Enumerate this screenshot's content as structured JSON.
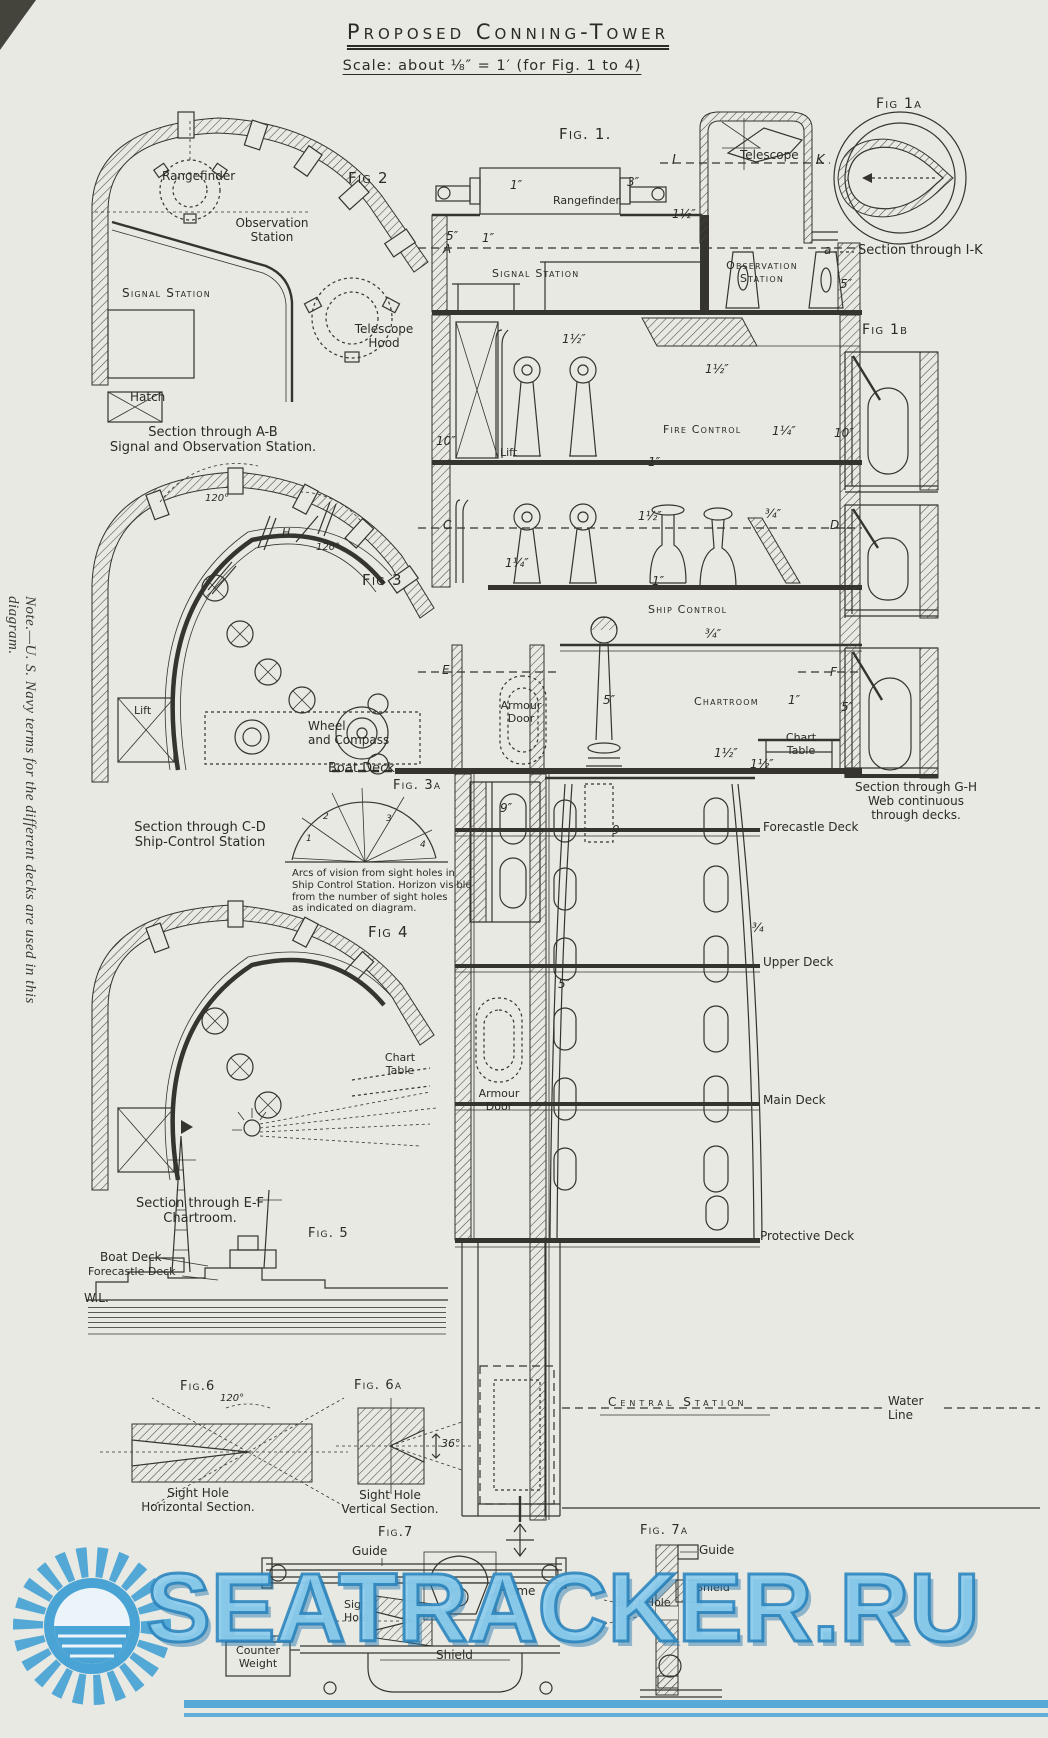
{
  "meta": {
    "title": "Proposed Conning-Tower",
    "subtitle": "Scale: about ⅛″ = 1′ (for Fig. 1 to 4)"
  },
  "side_note": "Note.—U. S. Navy terms for the different decks are used in this diagram.",
  "watermark": {
    "text": "SEATRACKER.RU",
    "color": "#4aa4d8"
  },
  "colors": {
    "paper": "#e8e9e3",
    "ink": "#35342e",
    "watermark_blue": "#4aa4d8"
  },
  "annotations": [
    {
      "name": "fig2-label",
      "text": "Fig 2",
      "x": 348,
      "y": 170,
      "fs": 15,
      "cls": "sc"
    },
    {
      "name": "fig2-rangefinder-label",
      "text": "Rangefinder",
      "x": 162,
      "y": 169,
      "fs": 12
    },
    {
      "name": "fig2-observation-station-label",
      "text": "Observation\nStation",
      "x": 272,
      "y": 216,
      "fs": 12,
      "cls": "c cap"
    },
    {
      "name": "fig2-signal-station-label",
      "text": "Signal Station",
      "x": 122,
      "y": 286,
      "fs": 12,
      "cls": "sc"
    },
    {
      "name": "fig2-telescope-hood-label",
      "text": "Telescope\nHood",
      "x": 384,
      "y": 322,
      "fs": 12,
      "cls": "c cap"
    },
    {
      "name": "fig2-hatch-label",
      "text": "Hatch",
      "x": 130,
      "y": 390,
      "fs": 12
    },
    {
      "name": "caption-section-ab",
      "text": "Section through A-B\nSignal and Observation Station.",
      "x": 213,
      "y": 425,
      "fs": 13,
      "cls": "c cap"
    },
    {
      "name": "fig1-label",
      "text": "Fig. 1.",
      "x": 559,
      "y": 126,
      "fs": 15,
      "cls": "sc"
    },
    {
      "name": "dim-1in-rangefinder",
      "text": "1″",
      "x": 510,
      "y": 178,
      "fs": 12,
      "cls": "d"
    },
    {
      "name": "dim-3in-rangefinder",
      "text": "3″",
      "x": 627,
      "y": 175,
      "fs": 12,
      "cls": "d"
    },
    {
      "name": "fig1-rangefinder-label",
      "text": "Rangefinder",
      "x": 553,
      "y": 195,
      "fs": 11
    },
    {
      "name": "marker-i",
      "text": "I",
      "x": 672,
      "y": 153,
      "fs": 13,
      "cls": "d"
    },
    {
      "name": "fig1-telescope-label",
      "text": "Telescope",
      "x": 740,
      "y": 148,
      "fs": 12
    },
    {
      "name": "marker-k",
      "text": "K",
      "x": 816,
      "y": 153,
      "fs": 13,
      "cls": "d"
    },
    {
      "name": "dim-1half-roof",
      "text": "1½″",
      "x": 672,
      "y": 207,
      "fs": 12,
      "cls": "d"
    },
    {
      "name": "dim-5in-wall-top",
      "text": "5″",
      "x": 446,
      "y": 229,
      "fs": 12,
      "cls": "d"
    },
    {
      "name": "dim-1in-wall-top",
      "text": "1″",
      "x": 482,
      "y": 231,
      "fs": 12,
      "cls": "d"
    },
    {
      "name": "marker-a-left",
      "text": "A",
      "x": 443,
      "y": 242,
      "fs": 12,
      "cls": "d"
    },
    {
      "name": "fig1-signal-station-label",
      "text": "Signal Station",
      "x": 492,
      "y": 268,
      "fs": 11,
      "cls": "sc"
    },
    {
      "name": "fig1-observation-station-label",
      "text": "Observation\nStation",
      "x": 762,
      "y": 260,
      "fs": 11,
      "cls": "c cap sc"
    },
    {
      "name": "dim-5in-obs",
      "text": "5″",
      "x": 840,
      "y": 277,
      "fs": 12,
      "cls": "d"
    },
    {
      "name": "fig1a-label",
      "text": "Fig 1a",
      "x": 876,
      "y": 96,
      "fs": 14,
      "cls": "sc"
    },
    {
      "name": "marker-a-small",
      "text": "a",
      "x": 824,
      "y": 243,
      "fs": 12,
      "cls": "d"
    },
    {
      "name": "caption-section-ik",
      "text": "Section through I-K",
      "x": 858,
      "y": 243,
      "fs": 13
    },
    {
      "name": "fig1b-label",
      "text": "Fig 1b",
      "x": 862,
      "y": 322,
      "fs": 14,
      "cls": "sc"
    },
    {
      "name": "dim-1half-firecontrol-left",
      "text": "1½″",
      "x": 562,
      "y": 332,
      "fs": 12,
      "cls": "d"
    },
    {
      "name": "dim-1half-firecontrol-right",
      "text": "1½″",
      "x": 705,
      "y": 362,
      "fs": 12,
      "cls": "d"
    },
    {
      "name": "fig1-fire-control-label",
      "text": "Fire Control",
      "x": 663,
      "y": 424,
      "fs": 11,
      "cls": "sc"
    },
    {
      "name": "dim-10in-wall",
      "text": "10″",
      "x": 436,
      "y": 434,
      "fs": 12,
      "cls": "d"
    },
    {
      "name": "fig1-lift-label",
      "text": "Lift",
      "x": 500,
      "y": 447,
      "fs": 11
    },
    {
      "name": "dim-1in-firecontrol",
      "text": "1″",
      "x": 648,
      "y": 455,
      "fs": 12,
      "cls": "d"
    },
    {
      "name": "dim-1quarter-fig1b",
      "text": "1¼″",
      "x": 772,
      "y": 424,
      "fs": 12,
      "cls": "d"
    },
    {
      "name": "dim-10in-fig1b",
      "text": "10″",
      "x": 834,
      "y": 426,
      "fs": 12,
      "cls": "d"
    },
    {
      "name": "marker-c",
      "text": "C",
      "x": 443,
      "y": 518,
      "fs": 12,
      "cls": "d"
    },
    {
      "name": "dim-1half-shipcontrol",
      "text": "1½″",
      "x": 638,
      "y": 509,
      "fs": 12,
      "cls": "d"
    },
    {
      "name": "dim-3quarter-fig1b",
      "text": "¾″",
      "x": 765,
      "y": 507,
      "fs": 12,
      "cls": "d"
    },
    {
      "name": "marker-d",
      "text": "D",
      "x": 830,
      "y": 518,
      "fs": 12,
      "cls": "d"
    },
    {
      "name": "dim-1quarter-wall",
      "text": "1¼″",
      "x": 505,
      "y": 556,
      "fs": 12,
      "cls": "d"
    },
    {
      "name": "dim-1in-shipcontrol",
      "text": "1″",
      "x": 652,
      "y": 574,
      "fs": 12,
      "cls": "d"
    },
    {
      "name": "fig1-ship-control-label",
      "text": "Ship Control",
      "x": 648,
      "y": 604,
      "fs": 11,
      "cls": "sc"
    },
    {
      "name": "dim-3quarter-floor",
      "text": "¾″",
      "x": 705,
      "y": 627,
      "fs": 12,
      "cls": "d"
    },
    {
      "name": "marker-e",
      "text": "E",
      "x": 442,
      "y": 663,
      "fs": 12,
      "cls": "d"
    },
    {
      "name": "fig1-armour-door-upper-label",
      "text": "Armour\nDoor",
      "x": 521,
      "y": 700,
      "fs": 11,
      "cls": "c cap"
    },
    {
      "name": "dim-5in-chartroom-wall",
      "text": "5″",
      "x": 603,
      "y": 693,
      "fs": 12,
      "cls": "d"
    },
    {
      "name": "fig1-chartroom-label",
      "text": "Chartroom",
      "x": 694,
      "y": 696,
      "fs": 11,
      "cls": "sc"
    },
    {
      "name": "dim-1in-chartroom",
      "text": "1″",
      "x": 788,
      "y": 693,
      "fs": 12,
      "cls": "d"
    },
    {
      "name": "marker-f",
      "text": "F",
      "x": 830,
      "y": 665,
      "fs": 12,
      "cls": "d"
    },
    {
      "name": "dim-5in-right-wall",
      "text": "5″",
      "x": 841,
      "y": 700,
      "fs": 12,
      "cls": "d"
    },
    {
      "name": "fig1-chart-table-label",
      "text": "Chart\nTable",
      "x": 801,
      "y": 732,
      "fs": 11,
      "cls": "c cap"
    },
    {
      "name": "dim-1half-boatdeck",
      "text": "1½″",
      "x": 714,
      "y": 746,
      "fs": 12,
      "cls": "d"
    },
    {
      "name": "boat-deck-label",
      "text": "Boat Deck",
      "x": 328,
      "y": 761,
      "fs": 13
    },
    {
      "name": "fig3a-label",
      "text": "Fig. 3a",
      "x": 393,
      "y": 778,
      "fs": 13,
      "cls": "sc"
    },
    {
      "name": "dim-9in-tube",
      "text": "9″",
      "x": 500,
      "y": 801,
      "fs": 12,
      "cls": "d"
    },
    {
      "name": "dim-9-tube",
      "text": "9",
      "x": 612,
      "y": 823,
      "fs": 12,
      "cls": "d"
    },
    {
      "name": "caption-section-gh",
      "text": "Section through G-H\nWeb continuous\nthrough decks.",
      "x": 916,
      "y": 780,
      "fs": 12,
      "cls": "c cap"
    },
    {
      "name": "dim-1half-forecastle",
      "text": "1½″",
      "x": 750,
      "y": 757,
      "fs": 12,
      "cls": "d"
    },
    {
      "name": "forecastle-deck-label",
      "text": "Forecastle Deck",
      "x": 763,
      "y": 820,
      "fs": 12
    },
    {
      "name": "fig3-label",
      "text": "Fig 3",
      "x": 362,
      "y": 572,
      "fs": 15,
      "cls": "sc"
    },
    {
      "name": "angle-120-fig3-a",
      "text": "120°",
      "x": 205,
      "y": 493,
      "fs": 10,
      "cls": "d"
    },
    {
      "name": "angle-120-fig3-b",
      "text": "120°",
      "x": 316,
      "y": 542,
      "fs": 10,
      "cls": "d"
    },
    {
      "name": "marker-h",
      "text": "H",
      "x": 282,
      "y": 527,
      "fs": 11,
      "cls": "d"
    },
    {
      "name": "fig3-lift-label",
      "text": "Lift",
      "x": 134,
      "y": 705,
      "fs": 11
    },
    {
      "name": "fig3-wheel-compass-label",
      "text": "Wheel\nand  Compass",
      "x": 308,
      "y": 719,
      "fs": 12
    },
    {
      "name": "caption-section-cd",
      "text": "Section through C-D\nShip-Control Station",
      "x": 200,
      "y": 820,
      "fs": 13,
      "cls": "c cap"
    },
    {
      "name": "fig3a-note",
      "text": "Arcs of vision from sight holes in\nShip Control Station. Horizon visible\nfrom the number of sight holes\nas indicated on diagram.",
      "x": 292,
      "y": 868,
      "fs": 10
    },
    {
      "name": "fan-1",
      "text": "1",
      "x": 306,
      "y": 834,
      "fs": 9,
      "cls": "d"
    },
    {
      "name": "fan-2",
      "text": "2",
      "x": 323,
      "y": 812,
      "fs": 9,
      "cls": "d"
    },
    {
      "name": "fan-3",
      "text": "3",
      "x": 386,
      "y": 814,
      "fs": 9,
      "cls": "d"
    },
    {
      "name": "fan-4",
      "text": "4",
      "x": 420,
      "y": 840,
      "fs": 9,
      "cls": "d"
    },
    {
      "name": "fig4-label",
      "text": "Fig 4",
      "x": 368,
      "y": 924,
      "fs": 15,
      "cls": "sc"
    },
    {
      "name": "fig4-chart-table-label",
      "text": "Chart\nTable",
      "x": 400,
      "y": 1052,
      "fs": 11,
      "cls": "c cap"
    },
    {
      "name": "dim-3quarter-upperdeck",
      "text": "¾",
      "x": 752,
      "y": 921,
      "fs": 12,
      "cls": "d"
    },
    {
      "name": "upper-deck-label",
      "text": "Upper Deck",
      "x": 763,
      "y": 955,
      "fs": 12
    },
    {
      "name": "dim-5in-tube",
      "text": "5″",
      "x": 558,
      "y": 977,
      "fs": 12,
      "cls": "d"
    },
    {
      "name": "fig1-armour-door-lower-label",
      "text": "Armour\nDoor",
      "x": 499,
      "y": 1088,
      "fs": 11,
      "cls": "c cap"
    },
    {
      "name": "main-deck-label",
      "text": "Main Deck",
      "x": 763,
      "y": 1093,
      "fs": 12
    },
    {
      "name": "caption-section-ef",
      "text": "Section through E-F\nChartroom.",
      "x": 200,
      "y": 1196,
      "fs": 13,
      "cls": "c cap"
    },
    {
      "name": "fig5-label",
      "text": "Fig. 5",
      "x": 308,
      "y": 1226,
      "fs": 13,
      "cls": "sc"
    },
    {
      "name": "fig5-boat-deck-label",
      "text": "Boat Deck",
      "x": 100,
      "y": 1250,
      "fs": 12
    },
    {
      "name": "fig5-forecastle-deck-label",
      "text": "Forecastle Deck",
      "x": 88,
      "y": 1266,
      "fs": 11
    },
    {
      "name": "wl-label",
      "text": "W.L.",
      "x": 84,
      "y": 1291,
      "fs": 12
    },
    {
      "name": "protective-deck-label",
      "text": "Protective Deck",
      "x": 760,
      "y": 1229,
      "fs": 12
    },
    {
      "name": "fig6-label",
      "text": "Fig.6",
      "x": 180,
      "y": 1379,
      "fs": 13,
      "cls": "sc"
    },
    {
      "name": "angle-120-fig6",
      "text": "120°",
      "x": 220,
      "y": 1393,
      "fs": 10,
      "cls": "d"
    },
    {
      "name": "fig6a-label",
      "text": "Fig. 6a",
      "x": 354,
      "y": 1378,
      "fs": 13,
      "cls": "sc"
    },
    {
      "name": "angle-36-fig6a",
      "text": "36°",
      "x": 441,
      "y": 1438,
      "fs": 11,
      "cls": "d"
    },
    {
      "name": "central-station-label",
      "text": "Central Station",
      "x": 608,
      "y": 1395,
      "fs": 12,
      "cls": "sc sp"
    },
    {
      "name": "water-line-label",
      "text": "Water\nLine",
      "x": 888,
      "y": 1394,
      "fs": 12
    },
    {
      "name": "caption-fig6",
      "text": "Sight Hole\nHorizontal Section.",
      "x": 198,
      "y": 1486,
      "fs": 12,
      "cls": "c cap"
    },
    {
      "name": "caption-fig6a",
      "text": "Sight Hole\nVertical Section.",
      "x": 390,
      "y": 1488,
      "fs": 12,
      "cls": "c cap"
    },
    {
      "name": "fig7-label",
      "text": "Fig.7",
      "x": 378,
      "y": 1525,
      "fs": 13,
      "cls": "sc"
    },
    {
      "name": "fig7-guide-label",
      "text": "Guide",
      "x": 352,
      "y": 1544,
      "fs": 12
    },
    {
      "name": "fig7-frame-label",
      "text": "Frame",
      "x": 498,
      "y": 1584,
      "fs": 12
    },
    {
      "name": "fig7-sight-hole-label",
      "text": "Sight\nHole",
      "x": 344,
      "y": 1599,
      "fs": 11
    },
    {
      "name": "fig7-counter-weight-label",
      "text": "Counter\nWeight",
      "x": 258,
      "y": 1645,
      "fs": 11,
      "cls": "c cap"
    },
    {
      "name": "fig7-shield-label",
      "text": "Shield",
      "x": 436,
      "y": 1648,
      "fs": 12
    },
    {
      "name": "fig7a-label",
      "text": "Fig. 7a",
      "x": 640,
      "y": 1523,
      "fs": 13,
      "cls": "sc"
    },
    {
      "name": "fig7a-guide-label",
      "text": "Guide",
      "x": 699,
      "y": 1543,
      "fs": 12
    },
    {
      "name": "fig7a-shield-label",
      "text": "Shield",
      "x": 696,
      "y": 1582,
      "fs": 11
    },
    {
      "name": "fig7a-sight-hole-label",
      "text": "Sight Hole",
      "x": 614,
      "y": 1597,
      "fs": 11
    }
  ]
}
